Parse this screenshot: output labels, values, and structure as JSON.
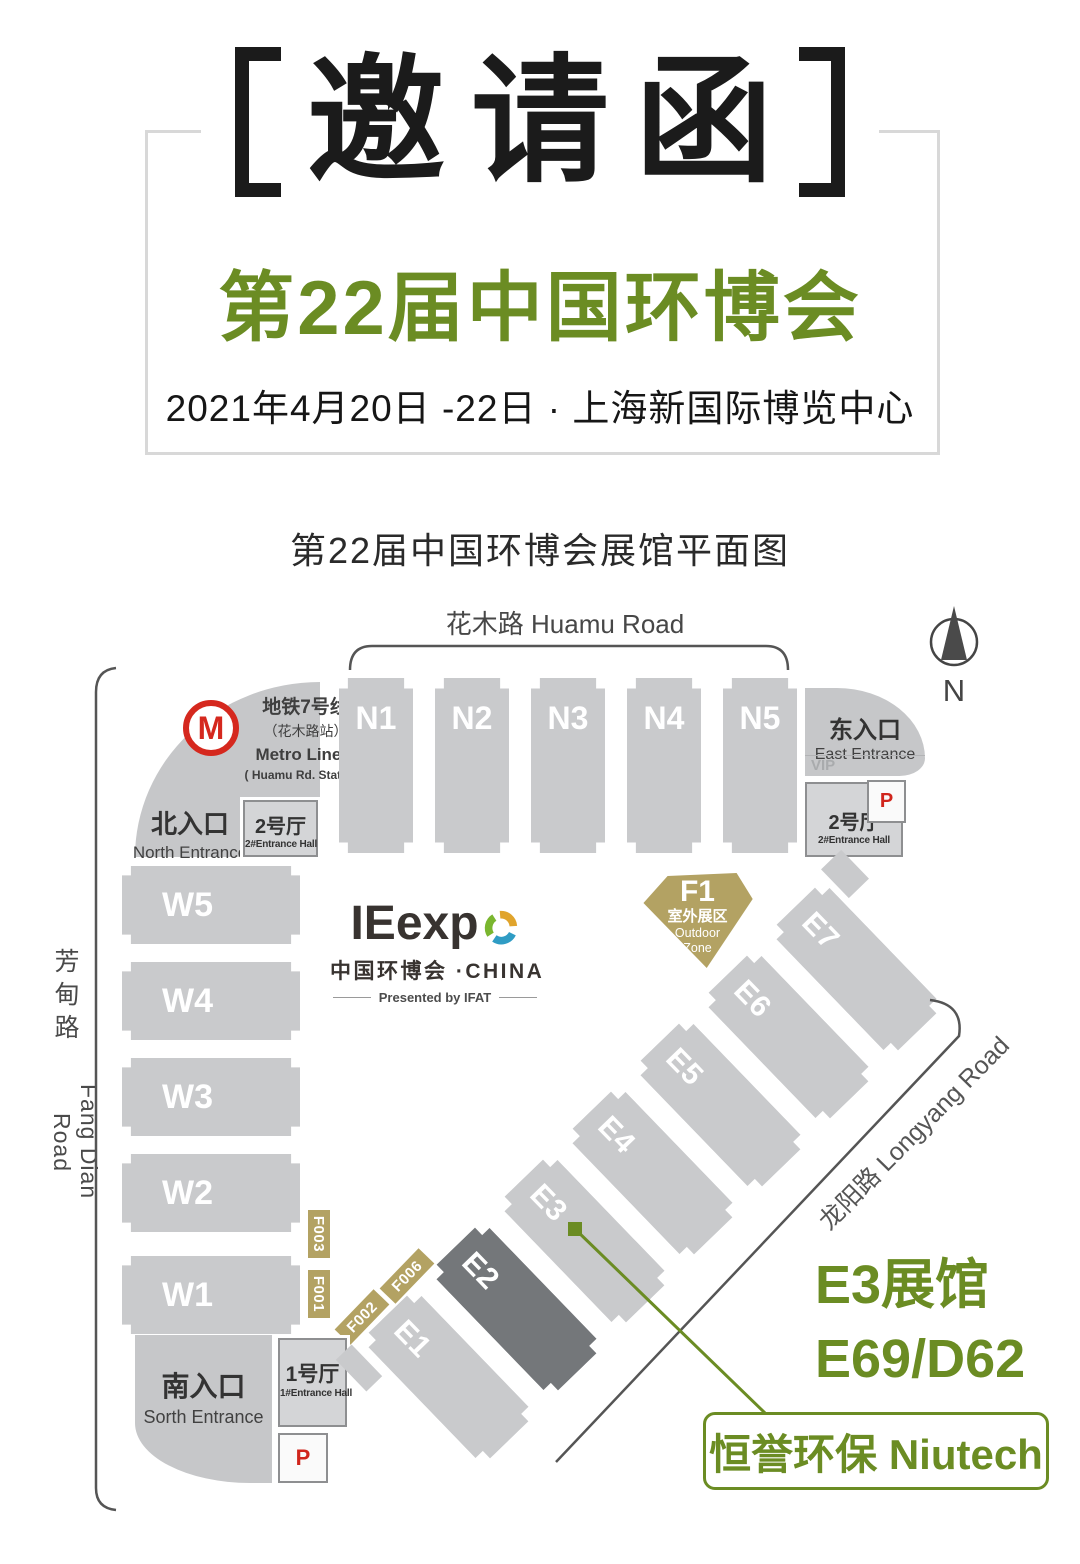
{
  "header": {
    "invitation_title": "邀请函",
    "expo_title": "第22届中国环博会",
    "date_venue": "2021年4月20日 -22日 · 上海新国际博览中心"
  },
  "map": {
    "title": "第22届中国环博会展馆平面图",
    "roads": {
      "huamu": "花木路 Huamu Road",
      "fangdian_cn1": "芳",
      "fangdian_cn2": "甸",
      "fangdian_cn3": "路",
      "fangdian_en": "Fang Dian Road",
      "longyang": "龙阳路 Longyang Road"
    },
    "compass": "N",
    "metro": {
      "logo_letter": "M",
      "line_cn": "地铁7号线",
      "station_cn": "（花木路站）",
      "line_en": "Metro Line 7",
      "station_en": "( Huamu Rd. Station )"
    },
    "entrances": {
      "north_cn": "北入口",
      "north_en": "North Entrance",
      "east_cn": "东入口",
      "east_en": "East Entrance",
      "east_vip": "VIP",
      "south_cn": "南入口",
      "south_en": "Sorth Entrance"
    },
    "entrance_halls": {
      "hall1_cn": "1号厅",
      "hall1_en": "1#Entrance Hall",
      "hall2_cn": "2号厅",
      "hall2_en": "2#Entrance Hall"
    },
    "parking": "P",
    "halls": {
      "north": [
        "N1",
        "N2",
        "N3",
        "N4",
        "N5"
      ],
      "west": [
        "W5",
        "W4",
        "W3",
        "W2",
        "W1"
      ],
      "east": [
        "E1",
        "E2",
        "E3",
        "E4",
        "E5",
        "E6",
        "E7"
      ],
      "highlighted": "E2"
    },
    "outdoor_zone": {
      "code": "F1",
      "cn": "室外展区",
      "en_line1": "Outdoor",
      "en_line2": "Zone"
    },
    "f_labels": [
      "F003",
      "F001",
      "F002",
      "F006"
    ],
    "logo": {
      "wordmark": "IEexp",
      "cn_line": "中国环博会 ·CHINA",
      "presented": "Presented by IFAT"
    },
    "callout": {
      "hall": "E3展馆",
      "booth": "E69/D62",
      "company": "恒誉环保 Niutech"
    }
  },
  "colors": {
    "accent_green": "#6b8c23",
    "gold": "#b3a263",
    "metro_red": "#d5281e",
    "parking_red": "#d0251c",
    "hall_gray": "#c9cacc",
    "hall_highlight_gray": "#74777a"
  }
}
